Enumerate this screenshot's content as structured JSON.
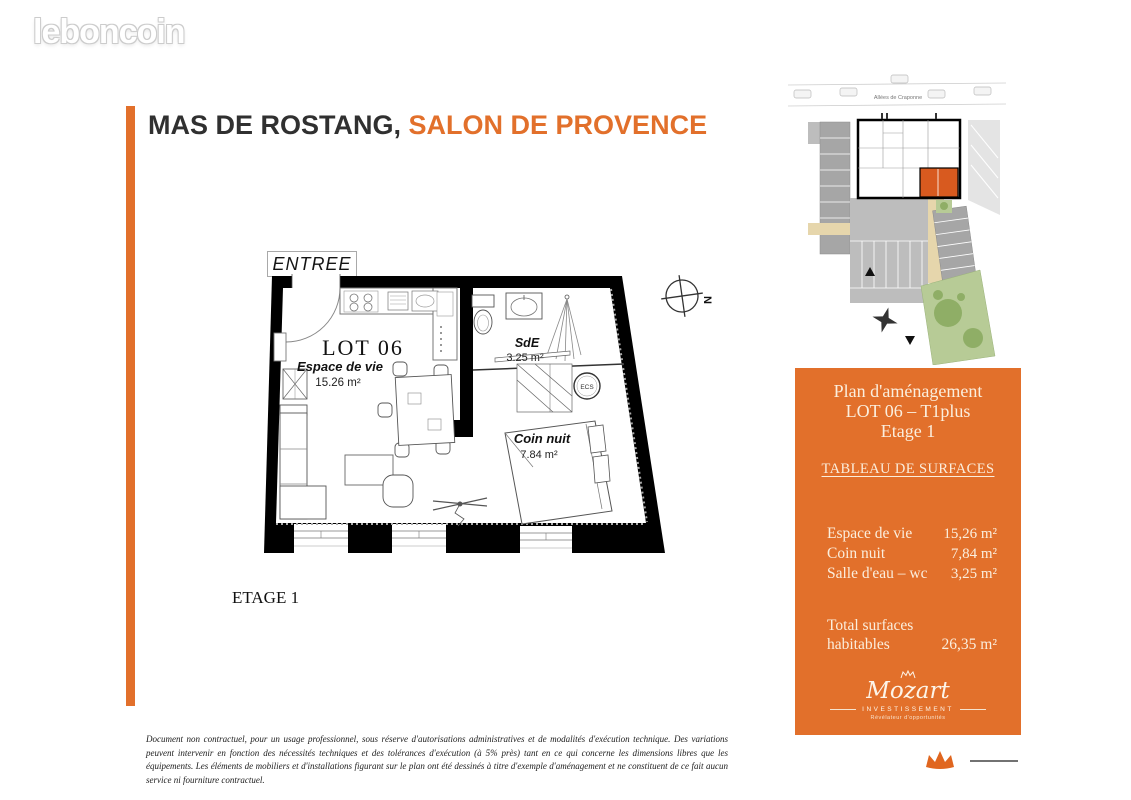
{
  "brand": {
    "logo_text": "leboncoin"
  },
  "title": {
    "part1": "MAS DE ROSTANG,",
    "part2": "SALON DE PROVENCE"
  },
  "floor_plan": {
    "entry_label": "ENTREE",
    "lot_label": "LOT 06",
    "rooms": [
      {
        "name": "Espace de vie",
        "area": "15.26 m²"
      },
      {
        "name": "SdE",
        "area": "3.25 m²"
      },
      {
        "name": "Coin nuit",
        "area": "7.84 m²"
      }
    ],
    "ecs_label": "ECS",
    "compass_label": "N",
    "floor_label": "ETAGE 1"
  },
  "site_plan": {
    "street_label": "Allées de Craponne"
  },
  "panel": {
    "heading": [
      "Plan d'aménagement",
      "LOT 06 – T1plus",
      "Etage 1"
    ],
    "table_title": "TABLEAU DE SURFACES",
    "rows": [
      {
        "label": "Espace de vie",
        "value": "15,26 m²"
      },
      {
        "label": "Coin nuit",
        "value": "7,84 m²"
      },
      {
        "label": "Salle d'eau – wc",
        "value": "3,25 m²"
      }
    ],
    "total": {
      "label": "Total surfaces habitables",
      "value": "26,35 m²"
    },
    "logo": {
      "name": "Mozart",
      "subtitle": "INVESTISSEMENT",
      "tagline": "Révélateur d'opportunités"
    }
  },
  "footer": {
    "disclaimer": "Document non contractuel, pour un usage professionnel, sous réserve d'autorisations administratives et de modalités d'exécution technique. Des variations peuvent intervenir en fonction des nécessités techniques et des tolérances d'exécution (à 5% près) tant en ce qui concerne les dimensions libres que les équipements. Les éléments de mobiliers et d'installations figurant sur le plan ont été dessinés à titre d'exemple d'aménagement et ne constituent de ce fait aucun service ni fourniture contractuel."
  },
  "colors": {
    "accent_orange": "#e2702b",
    "unit_highlight": "#d85a1f",
    "title_dark": "#303030",
    "wall_black": "#000000",
    "garden_green": "#b7cb96",
    "parking_gray": "#a6a6a6"
  }
}
